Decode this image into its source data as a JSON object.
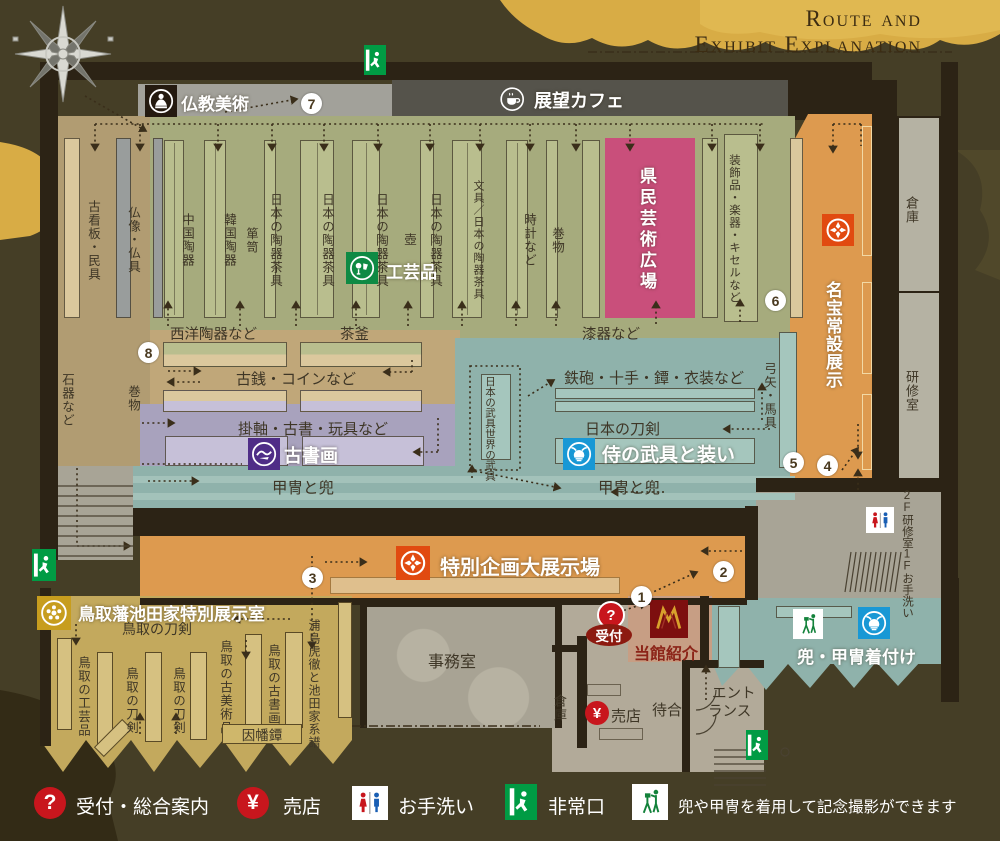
{
  "title": {
    "line1": "Route and",
    "line2": "Exhibit Explanation"
  },
  "top": {
    "buddhist_art": "仏教美術",
    "cafe": "展望カフェ"
  },
  "upper": {
    "col_kanban": "古看板・民具",
    "col_butsuzo": "仏像・仏具",
    "col_china": "中国陶器",
    "col_korea": "韓国陶器",
    "col_tansu": "箪笥",
    "col_tea1": "日本の陶器茶具",
    "col_tea2": "日本の陶器茶具",
    "col_tea3": "日本の陶器茶具",
    "col_tsubo": "壺",
    "col_tea4": "日本の陶器茶具",
    "col_bungu": "文具／日本の陶器茶具",
    "col_tokei": "時計など",
    "col_makimono": "巻物",
    "plaza": "県民芸術広場",
    "col_kazari": "装飾品・楽器・キセルなど",
    "craft": "工芸品",
    "western": "西洋陶器など",
    "chagama": "茶釜",
    "lacquer": "漆器など",
    "coins": "古銭・コインなど",
    "stone": "石器など",
    "scroll": "巻物",
    "kakejiku": "掛軸・古書・玩具など",
    "kosyoga": "古書画"
  },
  "samurai": {
    "yumiya": "弓矢・馬具",
    "teppo": "鉄砲・十手・鐔・衣装など",
    "box_japan": "日本の武具",
    "box_world": "世界の武具",
    "token": "日本の刀剣",
    "busou": "侍の武具と装い",
    "kacchu_left": "甲冑と兜",
    "kacchu_right": "甲冑と兜"
  },
  "meihou": {
    "label": "名宝常設展示"
  },
  "rooms_right": {
    "souko": "倉庫",
    "kenshu": "研修室",
    "f2": "2F研修室",
    "f1": "1Fお手洗い"
  },
  "special": {
    "label": "特別企画大展示場"
  },
  "tottori": {
    "title": "鳥取藩池田家特別展示室",
    "token_top": "鳥取の刀剣",
    "kogeihin": "鳥取の工芸品",
    "token1": "鳥取の刀剣",
    "token2": "鳥取の刀剣",
    "kobijutsu": "鳥取の古美術品",
    "kosyoga": "鳥取の古書画",
    "inaba": "因幡鐔",
    "urashima": "浦島虎徹と池田家系譜"
  },
  "lower": {
    "jimushitsu": "事務室",
    "uketsuke": "受付",
    "toukan": "当館紹介",
    "souko": "倉庫",
    "baiten": "売店",
    "machiai": "待合",
    "entrance1": "エント",
    "entrance2": "ランス",
    "kitsuke": "兜・甲冑着付け"
  },
  "numbers": [
    "1",
    "2",
    "3",
    "4",
    "5",
    "6",
    "7",
    "8"
  ],
  "legend": {
    "reception": "受付・総合案内",
    "shop": "売店",
    "toilet": "お手洗い",
    "exit": "非常口",
    "photo": "兜や甲冑を着用して記念撮影ができます"
  },
  "glyphs": {
    "question": "?",
    "yen": "¥"
  },
  "colors": {
    "background": "#453e26",
    "gold_cloud": "#d8ac45",
    "wall": "#2c2315",
    "hall_green": "#a6ab7d",
    "pink_plaza": "#c94f7b",
    "orange": "#dd9a4f",
    "teal": "#8fb2ab",
    "lavender": "#a8a2bd",
    "gold_zone": "#c3a95d",
    "crest_red": "#e14a10",
    "craft_green": "#0f8a44",
    "calligraphy_purple": "#4f2d87",
    "samurai_blue": "#1898d5",
    "tottori_gold": "#c79d1e",
    "legend_red": "#c8161d",
    "exit_green": "#009b44"
  }
}
